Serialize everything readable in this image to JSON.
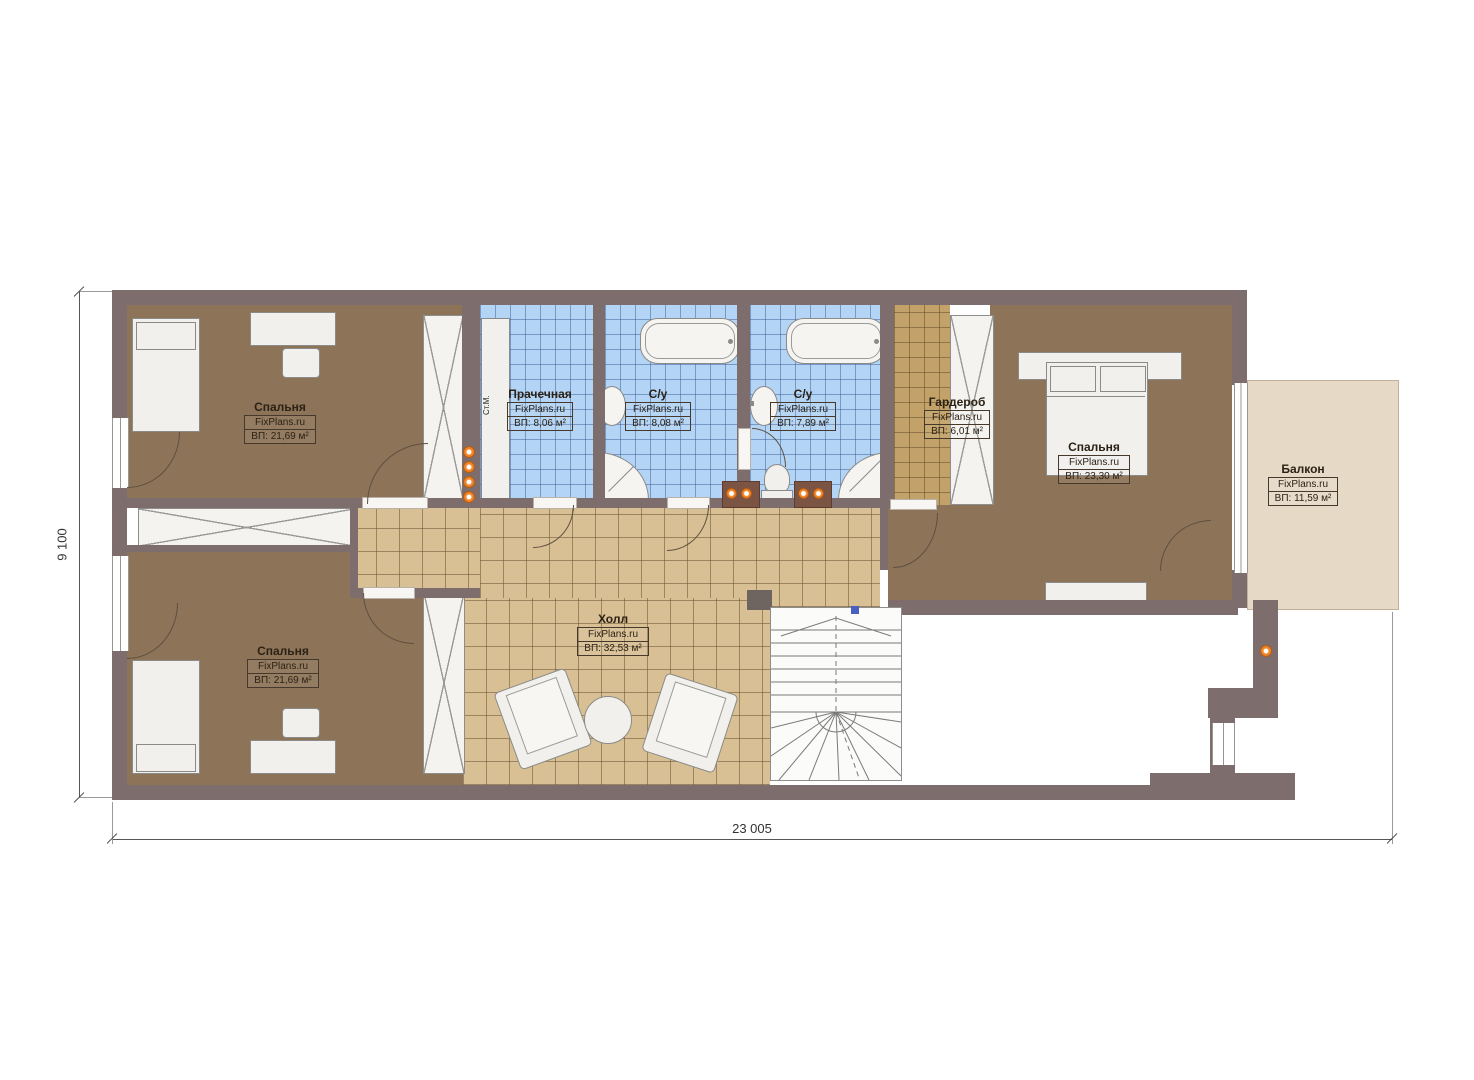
{
  "source_watermark": "FixPlans.ru",
  "rooms": [
    {
      "id": "bedroom-top-left",
      "name": "Спальня",
      "area": "ВП: 21,69 м²"
    },
    {
      "id": "laundry",
      "name": "Прачечная",
      "area": "ВП: 8,06 м²"
    },
    {
      "id": "bathroom-1",
      "name": "С/у",
      "area": "ВП: 8,08 м²"
    },
    {
      "id": "bathroom-2",
      "name": "С/у",
      "area": "ВП: 7,89 м²"
    },
    {
      "id": "wardrobe",
      "name": "Гардероб",
      "area": "ВП: 6,01 м²"
    },
    {
      "id": "bedroom-right",
      "name": "Спальня",
      "area": "ВП: 23,30 м²"
    },
    {
      "id": "balcony",
      "name": "Балкон",
      "area": "ВП: 11,59 м²"
    },
    {
      "id": "hall",
      "name": "Холл",
      "area": "ВП: 32,53 м²"
    },
    {
      "id": "bedroom-bottom-left",
      "name": "Спальня",
      "area": "ВП: 21,69 м²"
    }
  ],
  "dimensions": {
    "overall_width": "23 005",
    "overall_height": "9 100"
  },
  "annotations": {
    "washing_machine": "Ст.М."
  },
  "colors": {
    "wall": "#7d6d6c",
    "bedroom_floor": "#8d7458",
    "hall_floor": "#d8c094",
    "bath_floor": "#b3d4f4",
    "wardrobe_floor": "#c2a269",
    "balcony_floor": "#e6dac7",
    "accent_light": "#f08428"
  }
}
